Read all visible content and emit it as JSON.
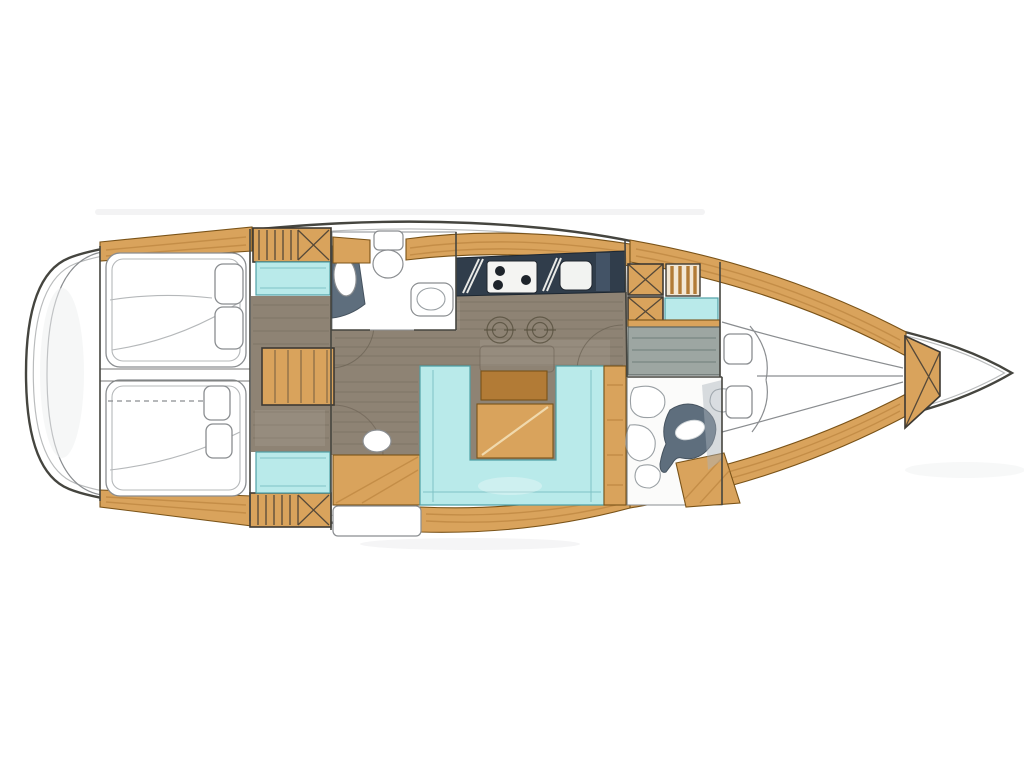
{
  "canvas": {
    "width": 1024,
    "height": 768
  },
  "artwork": {
    "type": "hand-drawn sailboat interior floor plan, top view",
    "orientation": "bow-right-stern-left",
    "text_visible": "none"
  },
  "palette": {
    "background": "#ffffff",
    "hull_outline": "#45453f",
    "outline_soft": "#8a8d90",
    "wood": "#d9a35c",
    "wood_light": "#edc88f",
    "wood_dark": "#b27b36",
    "wood_edge": "#7a5318",
    "hatch_border": "#3e3a33",
    "floor": "#8e8374",
    "floor_line": "#6a6153",
    "cyan": "#b9eaea",
    "cyan_edge": "#4fa0a6",
    "navy": "#303d4b",
    "gray_fixture": "#5e6e7d",
    "desk": "#9da6a2",
    "desk_line": "#71807d"
  },
  "features": [
    {
      "name": "hull-outline"
    },
    {
      "name": "stern-transom"
    },
    {
      "name": "aft-cabin-top-double-berth"
    },
    {
      "name": "aft-cabin-bottom-double-berth"
    },
    {
      "name": "companionway-hatch-top"
    },
    {
      "name": "companionway-hatch-bottom"
    },
    {
      "name": "aft-head-toilet-sink-shower"
    },
    {
      "name": "galley-counter-stove-sink"
    },
    {
      "name": "saloon-floor-planks"
    },
    {
      "name": "u-shaped-settee"
    },
    {
      "name": "saloon-table"
    },
    {
      "name": "chart-desk-nav-station"
    },
    {
      "name": "nav-lockers-crossed"
    },
    {
      "name": "forward-head-toilet"
    },
    {
      "name": "v-berth-forward-cabin"
    },
    {
      "name": "bow-locker-crossed"
    }
  ]
}
